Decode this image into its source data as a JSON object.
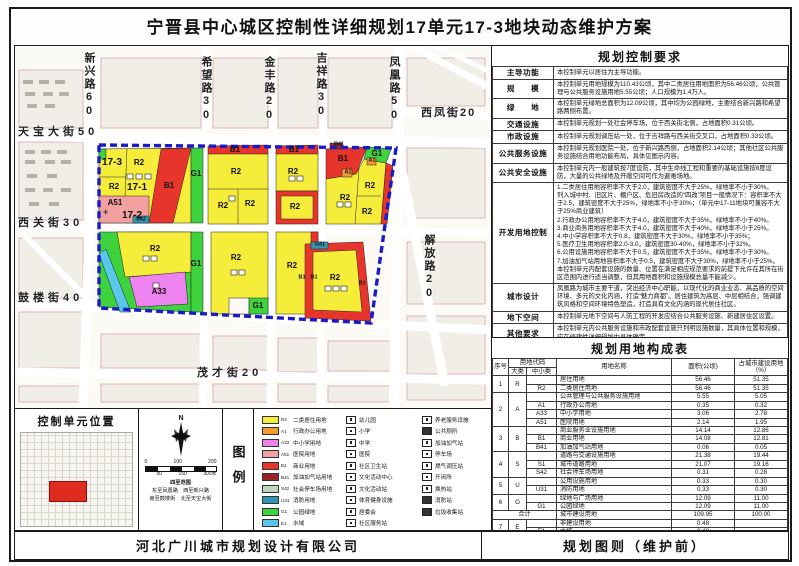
{
  "title": "宁晋县中心城区控制性详细规划17单元17-3地块动态维护方案",
  "footer": {
    "company": "河北广川城市规划设计有限公司",
    "sheet": "规划图则（维护前）"
  },
  "ctrl": {
    "title": "规划控制要求",
    "rows": [
      {
        "label": "主导功能",
        "text": "本控制单元以居住为主导功能。"
      },
      {
        "label": "规　　模",
        "text": "本控制单元用地规模为110.43公顷，其中二类居住用地面积为56.46公顷，公共管理与公共服务设施用地5.55公顷；人口规模为1.4万人。"
      },
      {
        "label": "绿　　地",
        "text": "本控制单元绿地总面积为12.09公顷，其中均为公园绿地，主要结合新兴路和希望路两侧布置。"
      },
      {
        "label": "交通设施",
        "text": "本控制单元规划一处社会停车场，位于西关街北侧，占地面积0.31公顷。"
      },
      {
        "label": "市政设施",
        "text": "本控制单元规划调压站一处，位于吉祥路与西关街交叉口，占地面积0.33公顷。"
      },
      {
        "label": "公共服务设施",
        "text": "本控制单元规划医院一处，位于新兴路西侧，占地面积2.14公顷；其他社区公共服务设施结合用地功能布局，具体见图示内容。"
      },
      {
        "label": "公共安全设施",
        "text": "本控制单元内一般建筑按7度设防，其中生命线工程和重要的基础设施按8度设防，大量的公共绿地及开敞空间可作为避难场地。"
      },
      {
        "label": "开发用地控制",
        "text": "1.二类居住用地容积率不大于2.0，建筑密度不大于25%，绿地率不小于30%。\n列入城中村、旧区片、棚户区、危旧房改造的“四改”项目一般情况下：容积率不大于2.5，建筑密度不大于25%，绿地率不小于30%；（单元中17-11地块可兼容不大于25%商业建筑）\n2.行政办公用地容积率不大于4.0，建筑密度不大于35%，绿地率不小于40%。\n3.商业商务用地容积率不大于4.0，建筑密度不大于40%，绿地率不小于25%。\n4.中小学容积率不大于0.8，建筑密度不大于30%，绿地率不小于35%；\n5.医疗卫生用地容积率2.0-3.0，建筑密度30-40%，绿地率不小于32%。\n6.公用设施用地容积率不大于0.5，建筑密度不大于35%，绿地率不小于30%。\n7.加油加气站用地容积率不大于0.5，建筑密度不大于30%，绿地率不小于25%。\n本控制单元内配套设施的数量、位置在满足相应规范要求的前提下允许在其所在街区范围内进行适当调整，但其用地面积和设施规模总量不能减少。"
      },
      {
        "label": "城市设计",
        "text": "凤凰路为城市主要干道，突出经济中心职能，以现代化的商业业态、高品质的空间环境、多元的文化内涵，打造“魅力商都”。居住建筑为高层、中层相结合，强调建筑风格和空间环境特色塑造，打造具有文化内涵的现代居住社区。"
      },
      {
        "label": "地下空间",
        "text": "本控制单元地下空间与人防工程的开发应结合公共服务设施、新建居住区设置。"
      },
      {
        "label": "其他要求",
        "text": "本控制单元内公共服务设施和市政配套设施只列明设施数量，其具体位置和规模，应在修建性详细规划中具体确定。"
      }
    ]
  },
  "landuse": {
    "title": "规划用地构成表",
    "headers": {
      "no": "序号",
      "code": "用地代码",
      "major": "大类",
      "minor": "中小类",
      "name": "用地名称",
      "area": "面积(公顷)",
      "pct": "占城市建设用地（%）"
    },
    "rows": [
      {
        "no": "1",
        "maj": "R",
        "name": "居住用地",
        "area": "56.46",
        "pct": "51.35"
      },
      {
        "min": "R2",
        "name": "二类居住用地",
        "area": "56.46",
        "pct": "51.35"
      },
      {
        "no": "2",
        "maj": "A",
        "name": "公共管理与公共服务设施用地",
        "area": "5.55",
        "pct": "5.05"
      },
      {
        "min": "A1",
        "name": "行政办公用地",
        "area": "0.35",
        "pct": "0.32"
      },
      {
        "min": "A33",
        "name": "中小学用地",
        "area": "3.06",
        "pct": "2.78"
      },
      {
        "min": "A51",
        "name": "医院用地",
        "area": "2.14",
        "pct": "1.95"
      },
      {
        "no": "3",
        "maj": "B",
        "name": "商业服务业设施用地",
        "area": "14.14",
        "pct": "12.86"
      },
      {
        "min": "B1",
        "name": "商业用地",
        "area": "14.08",
        "pct": "12.81"
      },
      {
        "min": "B41",
        "name": "加油加气站用地",
        "area": "0.06",
        "pct": "0.05"
      },
      {
        "no": "4",
        "maj": "S",
        "name": "道路与交通设施用地",
        "area": "21.38",
        "pct": "19.44"
      },
      {
        "min": "S1",
        "name": "城市道路用地",
        "area": "21.07",
        "pct": "19.16"
      },
      {
        "min": "S42",
        "name": "社会停车场用地",
        "area": "0.31",
        "pct": "0.28"
      },
      {
        "no": "5",
        "maj": "U",
        "name": "公用设施用地",
        "area": "0.33",
        "pct": "0.30"
      },
      {
        "min": "U31",
        "name": "消防用地",
        "area": "0.33",
        "pct": "0.30"
      },
      {
        "no": "6",
        "maj": "G",
        "name": "绿地与广场用地",
        "area": "12.09",
        "pct": "11.00"
      },
      {
        "min": "G1",
        "name": "公园绿地",
        "area": "12.09",
        "pct": "11.00"
      },
      {
        "total": "合计",
        "name": "城市建设用地",
        "area": "109.95",
        "pct": "100.00"
      },
      {
        "no": "7",
        "maj": "E",
        "name": "非建设用地",
        "area": "0.48",
        "pct": ""
      },
      {
        "min": "E1",
        "name": "水域",
        "area": "0.48",
        "pct": ""
      },
      {
        "name": "城乡用地",
        "area": "110.43",
        "pct": ""
      }
    ]
  },
  "location": {
    "title": "控制单元位置",
    "scale_top": [
      "0",
      "100",
      "200"
    ],
    "scale_bottom": [
      "50",
      "150",
      "300米"
    ],
    "bounds_title": "四至范围",
    "bounds_line1": "东至凤凰路　西至新兴路",
    "bounds_line2": "南至鼓楼街　北至天宝大街",
    "north": "N"
  },
  "legend": {
    "title": "图例",
    "col1": [
      {
        "code": "R2",
        "name": "二类居住用地",
        "color": "#f6ec3a"
      },
      {
        "code": "A1",
        "name": "行政办公用地",
        "color": "#f29a38"
      },
      {
        "code": "A33",
        "name": "中小学用地",
        "color": "#ee82ee"
      },
      {
        "code": "A51",
        "name": "医院用地",
        "color": "#f2a0a0"
      },
      {
        "code": "B1",
        "name": "商业用地",
        "color": "#e8352c"
      },
      {
        "code": "B41",
        "name": "加油加气站用地",
        "color": "#9c2121"
      },
      {
        "code": "S42",
        "name": "社会停车场用地",
        "color": "#bcd6bc"
      },
      {
        "code": "U31",
        "name": "消防用地",
        "color": "#2e96b4"
      },
      {
        "code": "G1",
        "name": "公园绿地",
        "color": "#3ed23c"
      },
      {
        "code": "E1",
        "name": "水域",
        "color": "#59c7ea"
      }
    ],
    "col2": [
      "幼儿园",
      "小学",
      "中学",
      "医院",
      "社区卫生站",
      "文化活动中心",
      "文化活动站",
      "体育健身设施",
      "居委会",
      "社区服务站"
    ],
    "col3": [
      "养老服务设施",
      "公共厕所",
      "加油加气站",
      "停车场",
      "燃气调压站",
      "开闭所",
      "换热站",
      "消防站",
      "垃圾收集站"
    ]
  },
  "map": {
    "boundary_color": "#1a1acb",
    "roads": {
      "xinxing": "新兴路60",
      "xiwang": "希望路30",
      "jinfeng": "金丰路20",
      "jixiang": "吉祥路30",
      "fenghuang": "凤凰路50",
      "jiefang": "解放路20",
      "tianbao": "天宝大街50",
      "xiguan": "西关街30",
      "gulou": "鼓楼街40",
      "maocai": "茂才街20",
      "xifeng": "西凤街20"
    },
    "labels": [
      "17-3",
      "R2",
      "R2",
      "17-1",
      "B1",
      "G1",
      "A51",
      "17-2",
      "S42",
      "B1",
      "R2",
      "R2",
      "R2",
      "B1",
      "R2",
      "R2",
      "B41",
      "B1",
      "G1",
      "A1",
      "A1",
      "R2",
      "R2",
      "R2",
      "R2",
      "A33",
      "G1",
      "R2",
      "G1",
      "R2",
      "B1",
      "B1",
      "U31",
      "R2",
      "B1"
    ]
  }
}
